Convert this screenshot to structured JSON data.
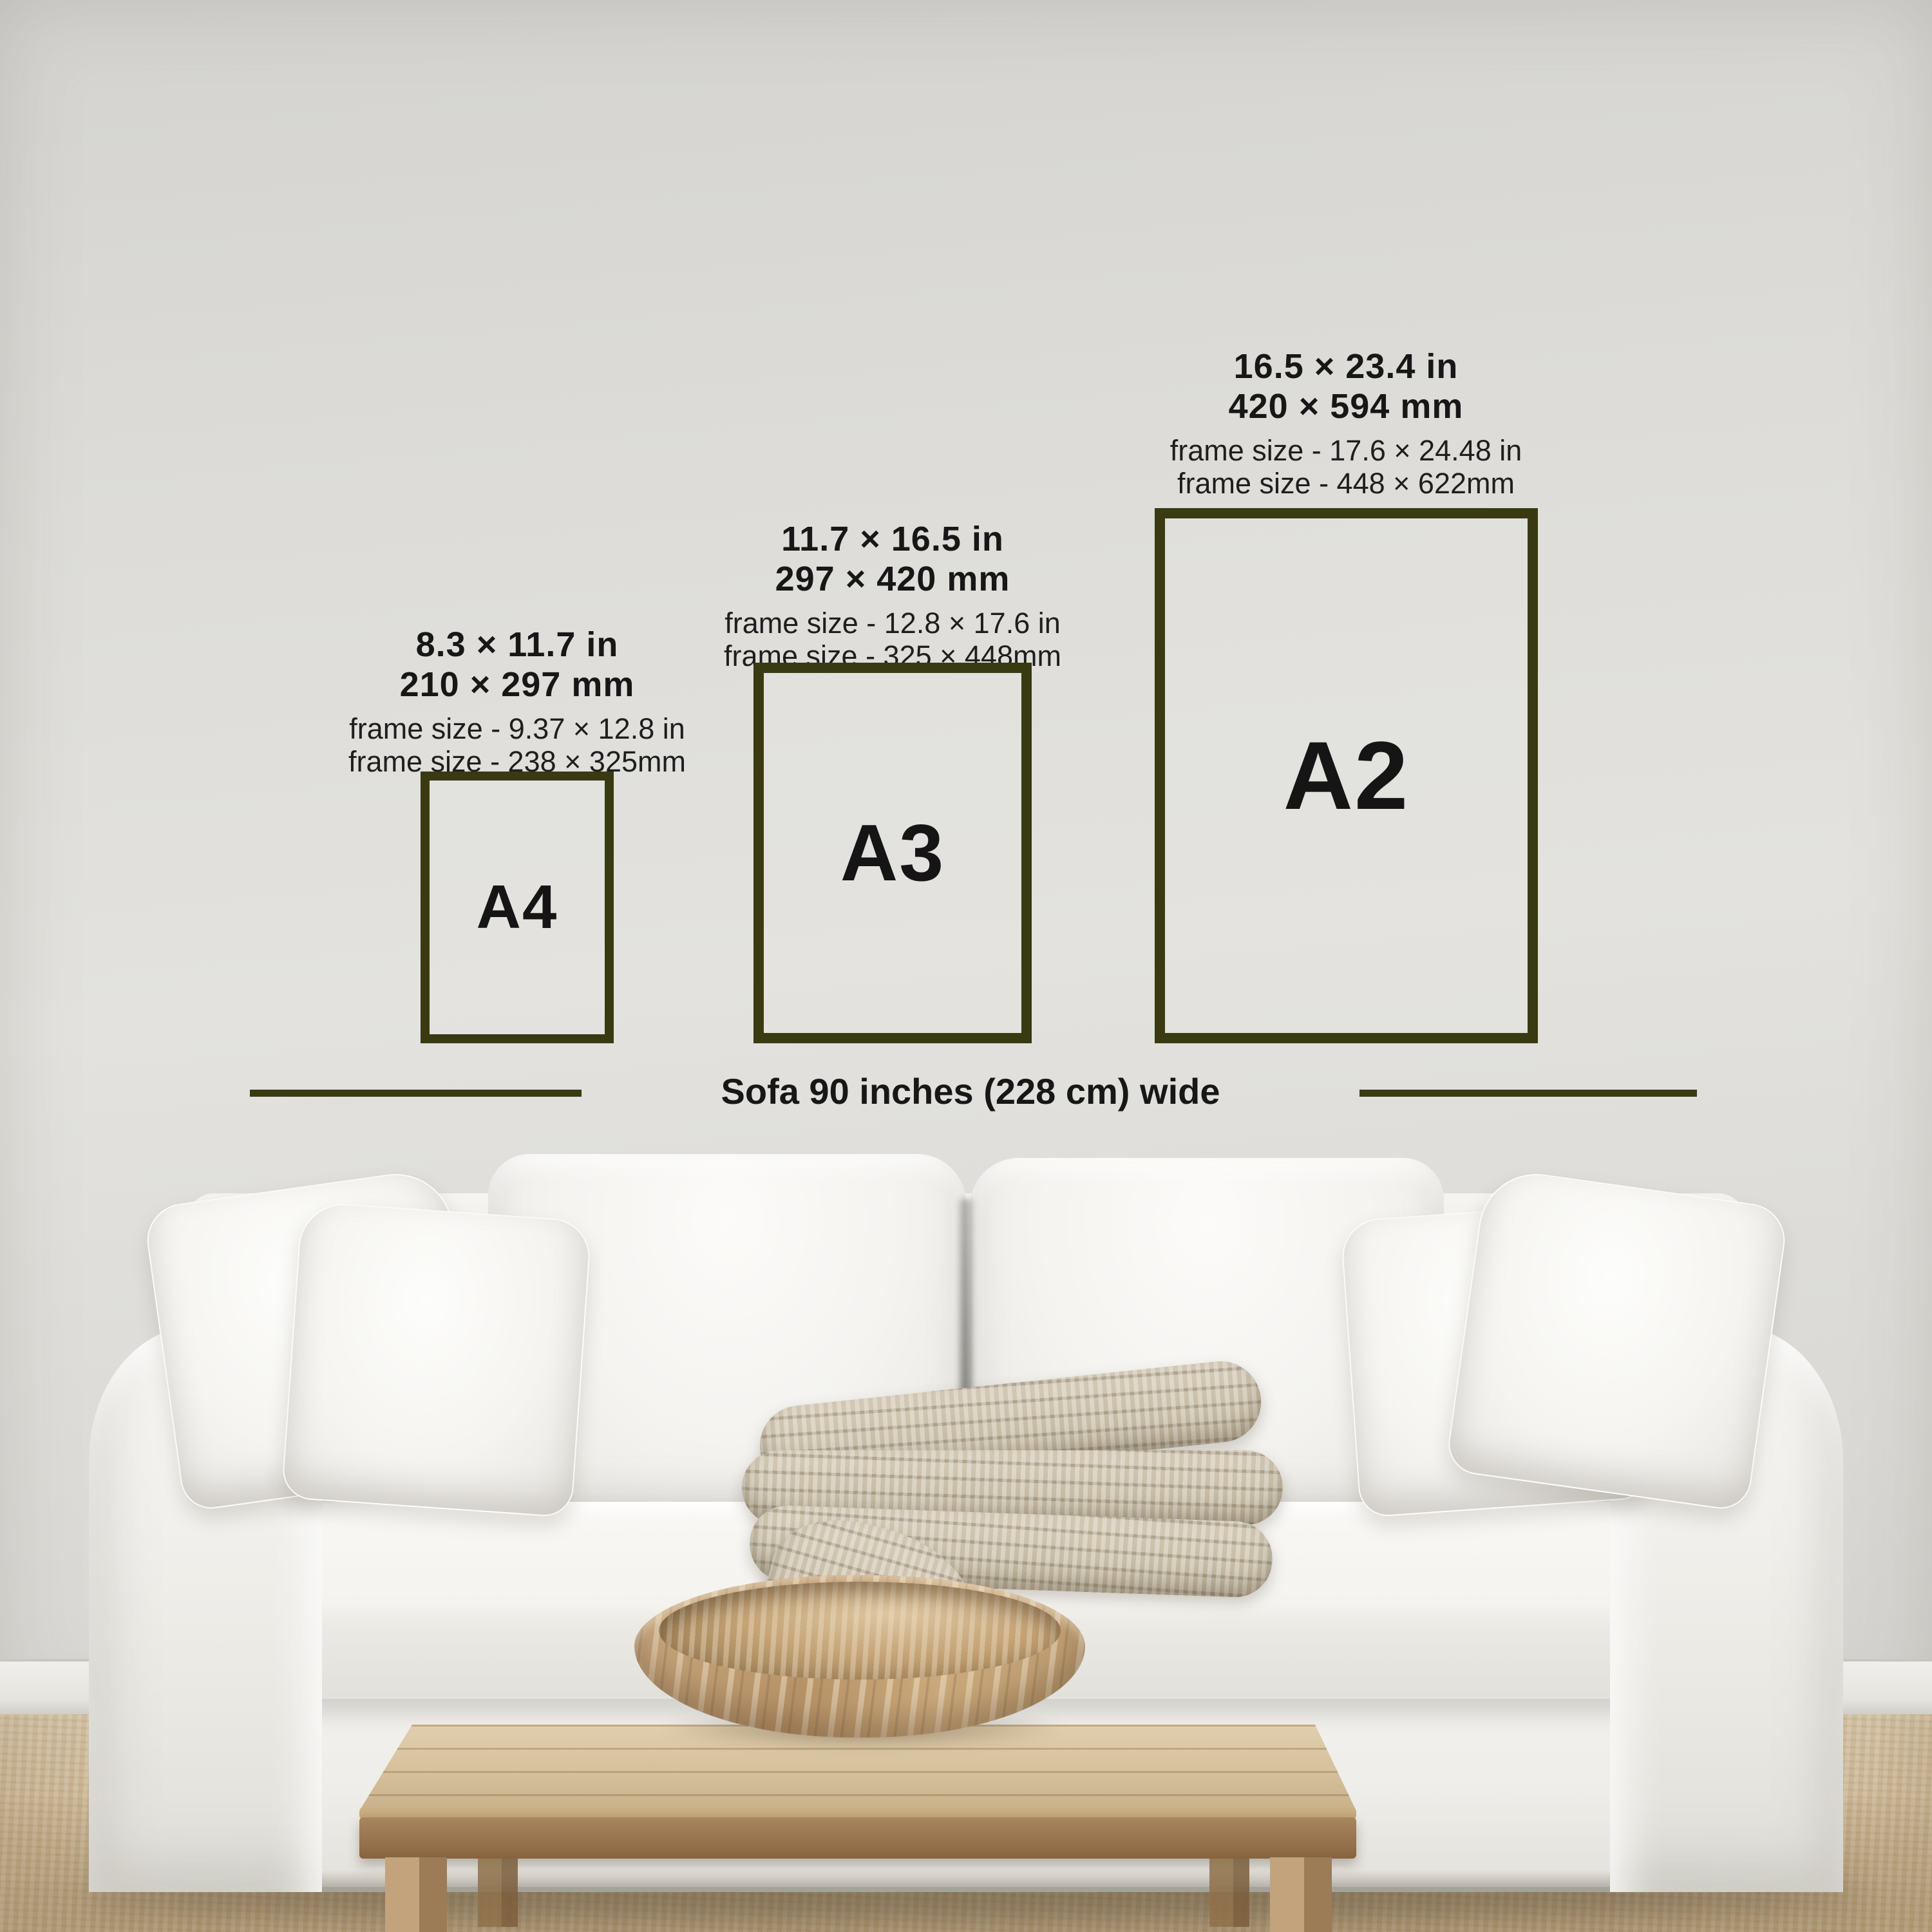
{
  "accent_color": "#3a3a12",
  "text_color": "#171717",
  "sizes": [
    {
      "id": "a4",
      "label": "A4",
      "dimensions_in": "8.3 × 11.7 in",
      "dimensions_mm": "210 × 297 mm",
      "frame_size_in": "frame size - 9.37 × 12.8 in",
      "frame_size_mm": "frame size - 238 × 325mm"
    },
    {
      "id": "a3",
      "label": "A3",
      "dimensions_in": "11.7 × 16.5 in",
      "dimensions_mm": "297 × 420 mm",
      "frame_size_in": "frame size - 12.8 × 17.6 in",
      "frame_size_mm": "frame size - 325 × 448mm"
    },
    {
      "id": "a2",
      "label": "A2",
      "dimensions_in": "16.5 × 23.4 in",
      "dimensions_mm": "420 × 594 mm",
      "frame_size_in": "frame size - 17.6 × 24.48 in",
      "frame_size_mm": "frame size - 448 × 622mm"
    }
  ],
  "sofa_caption": "Sofa 90 inches (228 cm) wide"
}
